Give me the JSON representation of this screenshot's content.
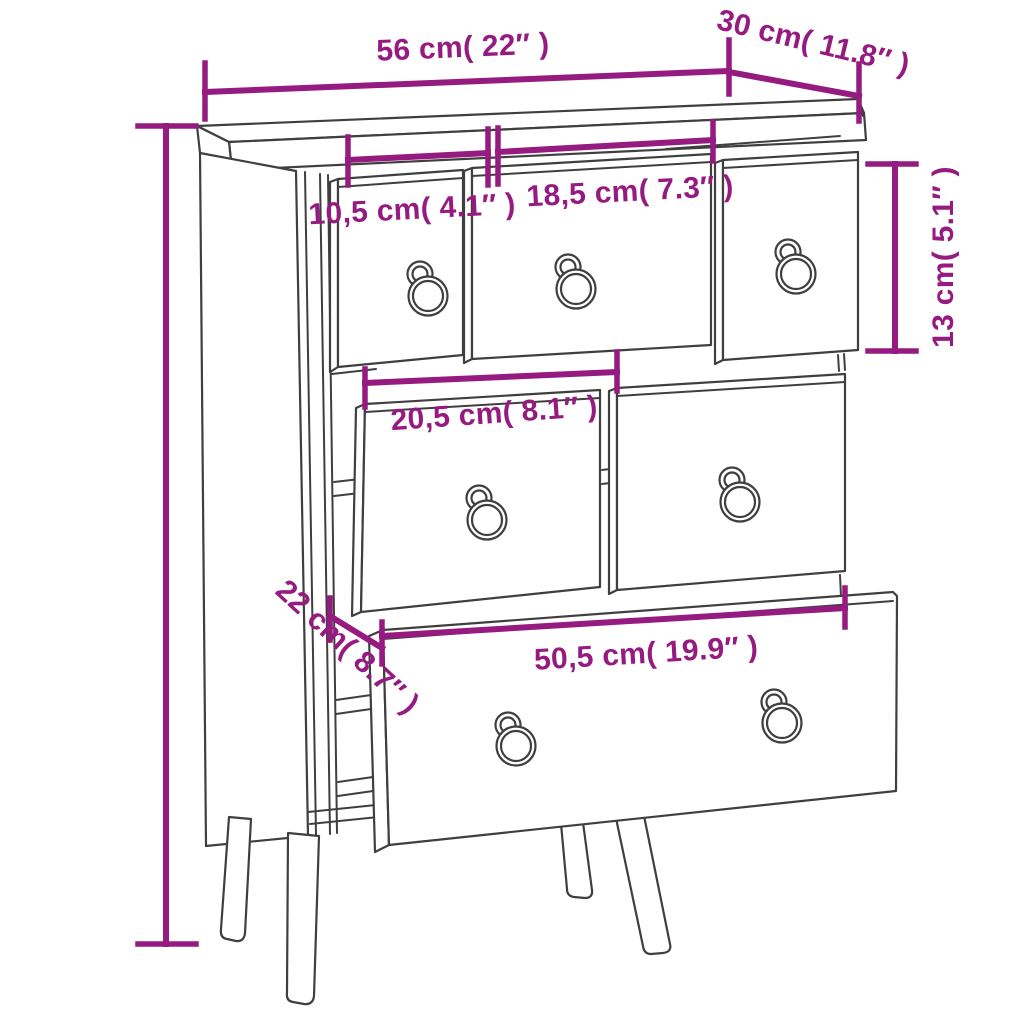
{
  "diagram": {
    "kind": "furniture dimension line drawing",
    "subject": "chest of drawers with 6 drawers, ring-pull handles and 4 splayed legs",
    "colors": {
      "background": "#ffffff",
      "accent": "#951b81",
      "line_art": "#3f3f3f"
    }
  },
  "dimensions": {
    "overall_width": {
      "label": "56 cm( 22″ )"
    },
    "overall_depth": {
      "label": "30 cm( 11.8″ )"
    },
    "small_drawer_width": {
      "label": "10,5 cm( 4.1″ )"
    },
    "medium_drawer_width": {
      "label": "18,5 cm( 7.3″ )"
    },
    "top_drawer_height": {
      "label": "13 cm( 5.1″ )"
    },
    "middle_drawer_width": {
      "label": "20,5 cm( 8.1″ )"
    },
    "bottom_drawer_height": {
      "label": "22 cm( 8.7″ )"
    },
    "bottom_drawer_width": {
      "label": "50,5 cm( 19.9″ )"
    }
  }
}
